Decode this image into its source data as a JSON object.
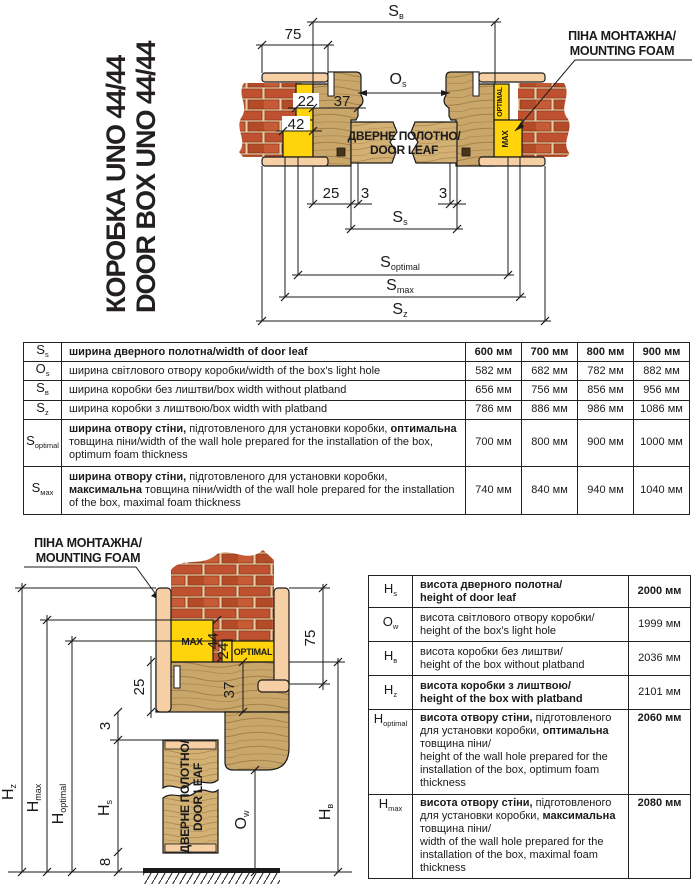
{
  "title": {
    "line1": "КОРОБКА UNO 44/44",
    "line2": "DOOR BOX UNO 44/44"
  },
  "foam_note": {
    "line1": "ПІНА МОНТАЖНА/",
    "line2": "MOUNTING FOAM"
  },
  "door_leaf": {
    "line1": "ДВЕРНЕ ПОЛОТНО/",
    "line2": "DOOR LEAF"
  },
  "foam_labels": {
    "optimal": "OPTIMAL",
    "max": "MAX"
  },
  "top_dims": {
    "sb": {
      "m": "S",
      "s": "в"
    },
    "os": {
      "m": "O",
      "s": "s"
    },
    "ss": {
      "m": "S",
      "s": "s"
    },
    "soptimal": {
      "m": "S",
      "s": "optimal"
    },
    "smax": {
      "m": "S",
      "s": "max"
    },
    "sz": {
      "m": "S",
      "s": "z"
    },
    "n75": "75",
    "n22": "22",
    "n37": "37",
    "n42": "42",
    "n25": "25",
    "n3a": "3",
    "n3b": "3"
  },
  "bottom_dims": {
    "hz": {
      "m": "H",
      "s": "z"
    },
    "hmax": {
      "m": "H",
      "s": "max"
    },
    "hoptimal": {
      "m": "H",
      "s": "optimal"
    },
    "hs": {
      "m": "H",
      "s": "s"
    },
    "ow": {
      "m": "O",
      "s": "w"
    },
    "hb": {
      "m": "H",
      "s": "в"
    },
    "n75": "75",
    "n44": "44",
    "n24": "24",
    "n25": "25",
    "n37": "37",
    "n3": "3",
    "n8": "8"
  },
  "width_table": {
    "rows": [
      {
        "sym": "S",
        "sub": "s",
        "b1": "ширина дверного полотна/width of door leaf",
        "r1": "",
        "b2": "",
        "r2": "",
        "v": [
          "600 мм",
          "700 мм",
          "800 мм",
          "900 мм"
        ]
      },
      {
        "sym": "O",
        "sub": "s",
        "b1": "",
        "r1": "ширина світлового отвору коробки/width of the box's light hole",
        "b2": "",
        "r2": "",
        "v": [
          "582 мм",
          "682 мм",
          "782 мм",
          "882 мм"
        ]
      },
      {
        "sym": "S",
        "sub": "в",
        "b1": "",
        "r1": "ширина коробки без лиштви/box width without platband",
        "b2": "",
        "r2": "",
        "v": [
          "656 мм",
          "756 мм",
          "856 мм",
          "956 мм"
        ]
      },
      {
        "sym": "S",
        "sub": "z",
        "b1": "",
        "r1": "ширина коробки з лиштвою/box width with platband",
        "b2": "",
        "r2": "",
        "v": [
          "786 мм",
          "886 мм",
          "986 мм",
          "1086 мм"
        ]
      },
      {
        "sym": "S",
        "sub": "optimal",
        "b1": "ширина отвору стіни,",
        "r1": " підготовленого для установки коробки, ",
        "b2": "оптимальна",
        "r2": " товщина піни/width of the wall hole prepared for the installation of the box, optimum foam thickness",
        "v": [
          "700 мм",
          "800 мм",
          "900 мм",
          "1000 мм"
        ]
      },
      {
        "sym": "S",
        "sub": "мах",
        "b1": "ширина отвору стіни,",
        "r1": " підготовленого для установки коробки, ",
        "b2": "максимальна",
        "r2": " товщина піни/width of the wall hole prepared for the installation of the box, maximal foam thickness",
        "v": [
          "740 мм",
          "840 мм",
          "940 мм",
          "1040 мм"
        ]
      }
    ]
  },
  "height_table": {
    "rows": [
      {
        "sym": "H",
        "sub": "s",
        "b1": "висота дверного полотна/",
        "r1": "",
        "b2": "",
        "r2": "",
        "en": "height of door leaf",
        "value": "2000 мм"
      },
      {
        "sym": "O",
        "sub": "w",
        "b1": "",
        "r1": "висота світлового отвору коробки/",
        "b2": "",
        "r2": "",
        "en": "height of the box's light hole",
        "value": "1999 мм"
      },
      {
        "sym": "H",
        "sub": "в",
        "b1": "",
        "r1": "висота коробки без лиштви/",
        "b2": "",
        "r2": "",
        "en": "height of the box without platband",
        "value": "2036 мм"
      },
      {
        "sym": "H",
        "sub": "z",
        "b1": "висота коробки з лиштвою/",
        "r1": "",
        "b2": "",
        "r2": "",
        "en": "height of the box with platband",
        "value": "2101 мм"
      },
      {
        "sym": "H",
        "sub": "optimal",
        "b1": "висота отвору стіни,",
        "r1": " підготовленого для установки коробки, ",
        "b2": "оптимальна",
        "r2": " товщина піни/",
        "en": "height of the wall hole prepared for the installation of the box, optimum foam thickness",
        "value": "2060 мм"
      },
      {
        "sym": "H",
        "sub": "max",
        "b1": "висота отвору стіни,",
        "r1": " підготовленого для установки коробки, ",
        "b2": "максимальна",
        "r2": " товщина піни/",
        "en": "width of the wall hole prepared for the installation of the box, maximal foam thickness",
        "value": "2080 мм"
      }
    ]
  },
  "colors": {
    "brick": "#bf5130",
    "mortar": "#e8cda6",
    "wood": "#c9a66a",
    "wood_light": "#d3b175",
    "grain": "#9a7743",
    "plaster": "#f6d0a4",
    "foam": "#ffd40d",
    "line": "#1a1a1a"
  }
}
